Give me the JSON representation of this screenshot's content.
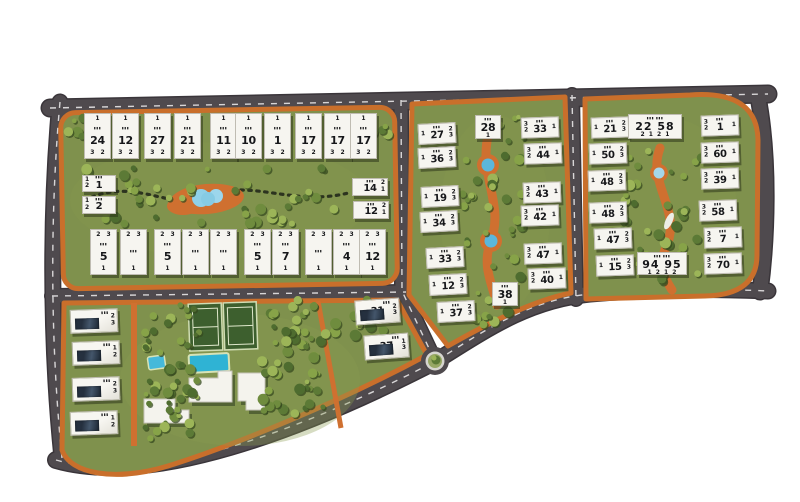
{
  "meta": {
    "type": "residential-compound-masterplan"
  },
  "palette": {
    "background": "#ffffff",
    "road": "#4f4a4e",
    "road_dash": "#d8d6d7",
    "block_green": "#7f914d",
    "path_orange": "#cf7030",
    "water": "#8fd0e8",
    "pool": "#2fb3d4",
    "court_green": "#3d5f2e",
    "building_white": "#f6f5f0",
    "text_dark": "#16171a",
    "tree_greens": [
      "#4e6c2f",
      "#5c7a36",
      "#6f8c3e",
      "#87a348",
      "#9cb558"
    ]
  },
  "misc": {
    "window_glyph": "▮▮▮"
  },
  "amenities": [
    {
      "name": "tennis-courts"
    },
    {
      "name": "swimming-pool"
    },
    {
      "name": "kids-pool"
    },
    {
      "name": "clubhouse-buildings"
    },
    {
      "name": "central-lake"
    },
    {
      "name": "roundabout"
    }
  ],
  "buildings": [
    {
      "block": "north-west",
      "cls": "vstack",
      "x": 84,
      "y": 113,
      "w": 27,
      "h": 46,
      "top": "1",
      "num": "24",
      "bottom": "3 2"
    },
    {
      "block": "north-west",
      "cls": "vstack",
      "x": 112,
      "y": 113,
      "w": 27,
      "h": 46,
      "top": "1",
      "num": "12",
      "bottom": "3 2"
    },
    {
      "block": "north-west",
      "cls": "vstack",
      "x": 144,
      "y": 113,
      "w": 27,
      "h": 46,
      "top": "1",
      "num": "27",
      "bottom": "3 2"
    },
    {
      "block": "north-west",
      "cls": "vstack",
      "x": 174,
      "y": 113,
      "w": 27,
      "h": 46,
      "top": "1",
      "num": "21",
      "bottom": "3 2"
    },
    {
      "block": "north-west",
      "cls": "vstack",
      "x": 210,
      "y": 113,
      "w": 27,
      "h": 46,
      "top": "1",
      "num": "11",
      "bottom": "3 2"
    },
    {
      "block": "north-west",
      "cls": "vstack",
      "x": 235,
      "y": 113,
      "w": 27,
      "h": 46,
      "top": "1",
      "num": "10",
      "bottom": "3 2"
    },
    {
      "block": "north-west",
      "cls": "vstack",
      "x": 264,
      "y": 113,
      "w": 27,
      "h": 46,
      "top": "1",
      "num": "1",
      "bottom": "3 2"
    },
    {
      "block": "north-west",
      "cls": "vstack",
      "x": 295,
      "y": 113,
      "w": 27,
      "h": 46,
      "top": "1",
      "num": "17",
      "bottom": "3 2"
    },
    {
      "block": "north-west",
      "cls": "vstack",
      "x": 324,
      "y": 113,
      "w": 27,
      "h": 46,
      "top": "1",
      "num": "17",
      "bottom": "3 2"
    },
    {
      "block": "north-west",
      "cls": "vstack",
      "x": 350,
      "y": 113,
      "w": 27,
      "h": 46,
      "top": "1",
      "num": "17",
      "bottom": "3 2"
    },
    {
      "block": "north-west",
      "cls": "vstack",
      "x": 90,
      "y": 229,
      "w": 27,
      "h": 46,
      "top": "2 3",
      "num": "5",
      "bottom": "1"
    },
    {
      "block": "north-west",
      "cls": "vstack",
      "x": 120,
      "y": 229,
      "w": 27,
      "h": 46,
      "top": "2 3",
      "num": "",
      "bottom": "1"
    },
    {
      "block": "north-west",
      "cls": "vstack",
      "x": 154,
      "y": 229,
      "w": 27,
      "h": 46,
      "top": "2 3",
      "num": "5",
      "bottom": "1"
    },
    {
      "block": "north-west",
      "cls": "vstack",
      "x": 182,
      "y": 229,
      "w": 27,
      "h": 46,
      "top": "2 3",
      "num": "",
      "bottom": "1"
    },
    {
      "block": "north-west",
      "cls": "vstack",
      "x": 210,
      "y": 229,
      "w": 27,
      "h": 46,
      "top": "2 3",
      "num": "",
      "bottom": "1"
    },
    {
      "block": "north-west",
      "cls": "vstack",
      "x": 244,
      "y": 229,
      "w": 27,
      "h": 46,
      "top": "2 3",
      "num": "5",
      "bottom": "1"
    },
    {
      "block": "north-west",
      "cls": "vstack",
      "x": 272,
      "y": 229,
      "w": 27,
      "h": 46,
      "top": "2 3",
      "num": "7",
      "bottom": "1"
    },
    {
      "block": "north-west",
      "cls": "vstack",
      "x": 305,
      "y": 229,
      "w": 27,
      "h": 46,
      "top": "2 3",
      "num": "",
      "bottom": "1"
    },
    {
      "block": "north-west",
      "cls": "vstack",
      "x": 333,
      "y": 229,
      "w": 27,
      "h": 46,
      "top": "2 3",
      "num": "4",
      "bottom": "1"
    },
    {
      "block": "north-west",
      "cls": "vstack",
      "x": 359,
      "y": 229,
      "w": 27,
      "h": 46,
      "top": "2 3",
      "num": "12",
      "bottom": "1"
    },
    {
      "block": "north-west",
      "cls": "hstack",
      "x": 82,
      "y": 175,
      "w": 34,
      "h": 17,
      "num": "1",
      "left": "1\n2"
    },
    {
      "block": "north-west",
      "cls": "hstack",
      "x": 82,
      "y": 196,
      "w": 34,
      "h": 18,
      "num": "2",
      "left": "1\n2"
    },
    {
      "block": "north-west",
      "cls": "hstack",
      "x": 352,
      "y": 178,
      "w": 36,
      "h": 18,
      "num": "14",
      "right": "2\n1"
    },
    {
      "block": "north-west",
      "cls": "hstack",
      "x": 353,
      "y": 201,
      "w": 36,
      "h": 18,
      "num": "12",
      "right": "2\n1"
    },
    {
      "block": "middle",
      "cls": "hstack",
      "x": 418,
      "y": 123,
      "w": 38,
      "h": 21,
      "rot": -3,
      "num": "27",
      "left": "1",
      "right": "2\n3"
    },
    {
      "block": "middle",
      "cls": "hstack",
      "x": 418,
      "y": 147,
      "w": 38,
      "h": 21,
      "rot": -3,
      "num": "36",
      "left": "1",
      "right": "2\n3"
    },
    {
      "block": "middle",
      "cls": "hstack",
      "x": 421,
      "y": 186,
      "w": 38,
      "h": 21,
      "rot": -3,
      "num": "19",
      "left": "1",
      "right": "2\n3"
    },
    {
      "block": "middle",
      "cls": "hstack",
      "x": 420,
      "y": 211,
      "w": 38,
      "h": 21,
      "rot": -3,
      "num": "34",
      "left": "1",
      "right": "2\n3"
    },
    {
      "block": "middle",
      "cls": "hstack",
      "x": 426,
      "y": 247,
      "w": 38,
      "h": 21,
      "rot": -3,
      "num": "33",
      "left": "1",
      "right": "2\n3"
    },
    {
      "block": "middle",
      "cls": "hstack",
      "x": 429,
      "y": 274,
      "w": 38,
      "h": 21,
      "rot": -3,
      "num": "12",
      "left": "1",
      "right": "2\n3"
    },
    {
      "block": "middle",
      "cls": "hstack",
      "x": 437,
      "y": 301,
      "w": 38,
      "h": 21,
      "rot": -3,
      "num": "37",
      "left": "1",
      "right": "2\n3"
    },
    {
      "block": "middle",
      "cls": "vstack",
      "x": 475,
      "y": 115,
      "w": 26,
      "h": 24,
      "num": "28",
      "bottom": "1"
    },
    {
      "block": "middle",
      "cls": "vstack",
      "x": 492,
      "y": 282,
      "w": 26,
      "h": 24,
      "num": "38",
      "bottom": "1"
    },
    {
      "block": "middle",
      "cls": "hstack",
      "x": 521,
      "y": 117,
      "w": 38,
      "h": 21,
      "rot": -2,
      "num": "33",
      "left": "3\n2",
      "right": "1"
    },
    {
      "block": "middle",
      "cls": "hstack",
      "x": 524,
      "y": 143,
      "w": 38,
      "h": 21,
      "rot": -2,
      "num": "44",
      "left": "3\n2",
      "right": "1"
    },
    {
      "block": "middle",
      "cls": "hstack",
      "x": 523,
      "y": 182,
      "w": 38,
      "h": 21,
      "rot": -2,
      "num": "43",
      "left": "3\n2",
      "right": "1"
    },
    {
      "block": "middle",
      "cls": "hstack",
      "x": 521,
      "y": 205,
      "w": 38,
      "h": 21,
      "rot": -2,
      "num": "42",
      "left": "3\n2",
      "right": "1"
    },
    {
      "block": "middle",
      "cls": "hstack",
      "x": 524,
      "y": 243,
      "w": 38,
      "h": 21,
      "rot": -2,
      "num": "47",
      "left": "3\n2",
      "right": "1"
    },
    {
      "block": "middle",
      "cls": "hstack",
      "x": 528,
      "y": 268,
      "w": 38,
      "h": 21,
      "rot": -2,
      "num": "40",
      "left": "3\n2",
      "right": "1"
    },
    {
      "block": "east",
      "cls": "hstack",
      "x": 591,
      "y": 117,
      "w": 38,
      "h": 21,
      "rot": -2,
      "num": "21",
      "left": "1",
      "right": "2\n3"
    },
    {
      "block": "east",
      "cls": "hstack",
      "x": 589,
      "y": 143,
      "w": 38,
      "h": 21,
      "rot": -2,
      "num": "50",
      "left": "1",
      "right": "2\n3"
    },
    {
      "block": "east",
      "cls": "hstack",
      "x": 588,
      "y": 170,
      "w": 38,
      "h": 21,
      "rot": -2,
      "num": "48",
      "left": "1",
      "right": "2\n3"
    },
    {
      "block": "east",
      "cls": "hstack",
      "x": 589,
      "y": 202,
      "w": 38,
      "h": 21,
      "rot": -2,
      "num": "48",
      "left": "1",
      "right": "2\n3"
    },
    {
      "block": "east",
      "cls": "hstack",
      "x": 594,
      "y": 228,
      "w": 38,
      "h": 21,
      "rot": -2,
      "num": "47",
      "left": "1",
      "right": "2\n3"
    },
    {
      "block": "east",
      "cls": "hstack",
      "x": 596,
      "y": 255,
      "w": 38,
      "h": 21,
      "rot": -2,
      "num": "15",
      "left": "1",
      "right": "2\n3"
    },
    {
      "block": "east",
      "cls": "wide",
      "x": 628,
      "y": 114,
      "w": 54,
      "h": 25,
      "num": "22 58",
      "bottom": "2 1 2 1"
    },
    {
      "block": "east",
      "cls": "wide",
      "x": 637,
      "y": 252,
      "w": 50,
      "h": 23,
      "num": "94 95",
      "bottom": "1 2 1 2"
    },
    {
      "block": "east",
      "cls": "hstack",
      "x": 701,
      "y": 115,
      "w": 38,
      "h": 21,
      "rot": -2,
      "num": "1",
      "left": "3\n2",
      "right": "1"
    },
    {
      "block": "east",
      "cls": "hstack",
      "x": 701,
      "y": 142,
      "w": 38,
      "h": 21,
      "rot": -2,
      "num": "60",
      "left": "3\n2",
      "right": "1"
    },
    {
      "block": "east",
      "cls": "hstack",
      "x": 701,
      "y": 168,
      "w": 38,
      "h": 21,
      "rot": -2,
      "num": "39",
      "left": "3\n2",
      "right": "1"
    },
    {
      "block": "east",
      "cls": "hstack",
      "x": 699,
      "y": 200,
      "w": 38,
      "h": 21,
      "rot": -2,
      "num": "58",
      "left": "3\n2",
      "right": "1"
    },
    {
      "block": "east",
      "cls": "hstack",
      "x": 704,
      "y": 227,
      "w": 38,
      "h": 21,
      "rot": -2,
      "num": "7",
      "left": "3\n2",
      "right": "1"
    },
    {
      "block": "east",
      "cls": "hstack",
      "x": 704,
      "y": 253,
      "w": 38,
      "h": 21,
      "rot": -2,
      "num": "70",
      "left": "3\n2",
      "right": "1"
    },
    {
      "block": "amenity",
      "cls": "villa",
      "x": 70,
      "y": 309,
      "w": 48,
      "h": 24,
      "rot": -2,
      "num": "",
      "right": "2\n3"
    },
    {
      "block": "amenity",
      "cls": "villa",
      "x": 72,
      "y": 341,
      "w": 48,
      "h": 24,
      "rot": -2,
      "num": "",
      "right": "1\n2"
    },
    {
      "block": "amenity",
      "cls": "villa",
      "x": 72,
      "y": 377,
      "w": 48,
      "h": 24,
      "rot": -2,
      "num": "",
      "right": "2\n3"
    },
    {
      "block": "amenity",
      "cls": "villa",
      "x": 70,
      "y": 411,
      "w": 48,
      "h": 24,
      "rot": -2,
      "num": "",
      "right": "1\n2"
    },
    {
      "block": "amenity",
      "cls": "villa",
      "x": 355,
      "y": 299,
      "w": 45,
      "h": 25,
      "rot": -4,
      "num": "31",
      "right": "2\n3"
    },
    {
      "block": "amenity",
      "cls": "villa",
      "x": 364,
      "y": 334,
      "w": 45,
      "h": 25,
      "rot": -4,
      "num": "37",
      "right": "1\n3"
    }
  ]
}
